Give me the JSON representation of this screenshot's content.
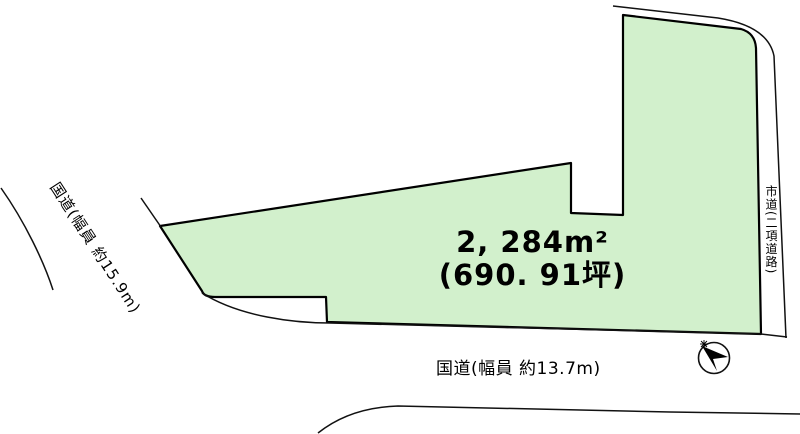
{
  "diagram": {
    "title": "land-plot-survey-diagram",
    "plot": {
      "area_m2": "2, 284m²",
      "area_tsubo": "(690. 91坪)",
      "fill_color": "#d2f0cc",
      "outline_color": "#000000"
    },
    "roads": {
      "left_label": "国道(幅員 約15.9m)",
      "bottom_label": "国道(幅員 約13.7m)",
      "right_label": "市道(二項道路)"
    },
    "compass": {
      "icon": "north-arrow-compass"
    }
  }
}
